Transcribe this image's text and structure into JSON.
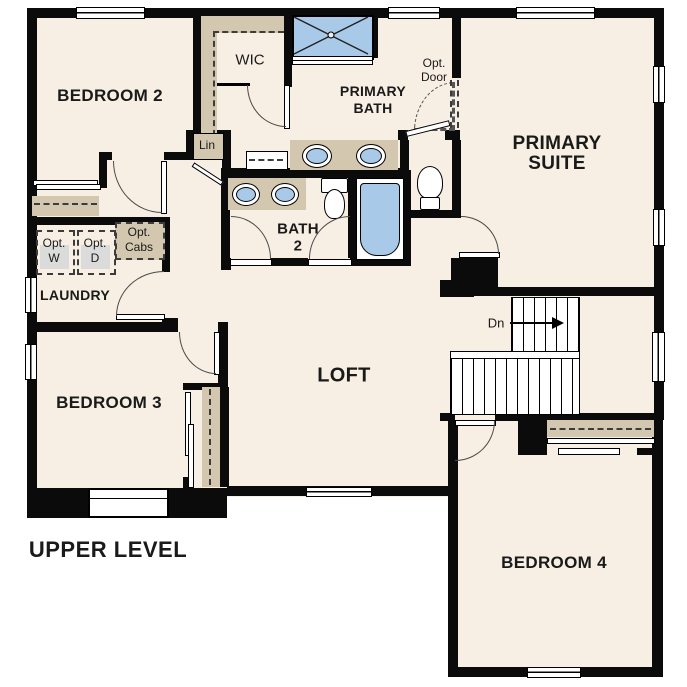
{
  "title": "UPPER LEVEL",
  "colors": {
    "floor": "#f7efe3",
    "wall": "#0b0b0b",
    "cabinet_tan": "#d4c7af",
    "fixture_blue": "#a9c9e9",
    "appliance_gray": "#dbdbdb"
  },
  "labels": {
    "bedroom2": "BEDROOM 2",
    "bedroom3": "BEDROOM 3",
    "bedroom4": "BEDROOM 4",
    "primary_suite_l1": "PRIMARY",
    "primary_suite_l2": "SUITE",
    "primary_bath_l1": "PRIMARY",
    "primary_bath_l2": "BATH",
    "bath2_l1": "BATH",
    "bath2_l2": "2",
    "loft": "LOFT",
    "laundry": "LAUNDRY",
    "wic": "WIC",
    "linen": "Lin",
    "opt_door_l1": "Opt.",
    "opt_door_l2": "Door",
    "opt_washer_l1": "Opt.",
    "opt_washer_l2": "W",
    "opt_dryer_l1": "Opt.",
    "opt_dryer_l2": "D",
    "opt_cabs_l1": "Opt.",
    "opt_cabs_l2": "Cabs",
    "stairs_down": "Dn",
    "plan_title": "UPPER LEVEL"
  },
  "fixtures": [
    "shower",
    "double-vanity-sink",
    "single-vanity-sink",
    "toilet",
    "bathtub",
    "stairs-down-arrow",
    "closet-rod",
    "window",
    "door-swing",
    "optional-washer",
    "optional-dryer",
    "optional-cabinets"
  ]
}
